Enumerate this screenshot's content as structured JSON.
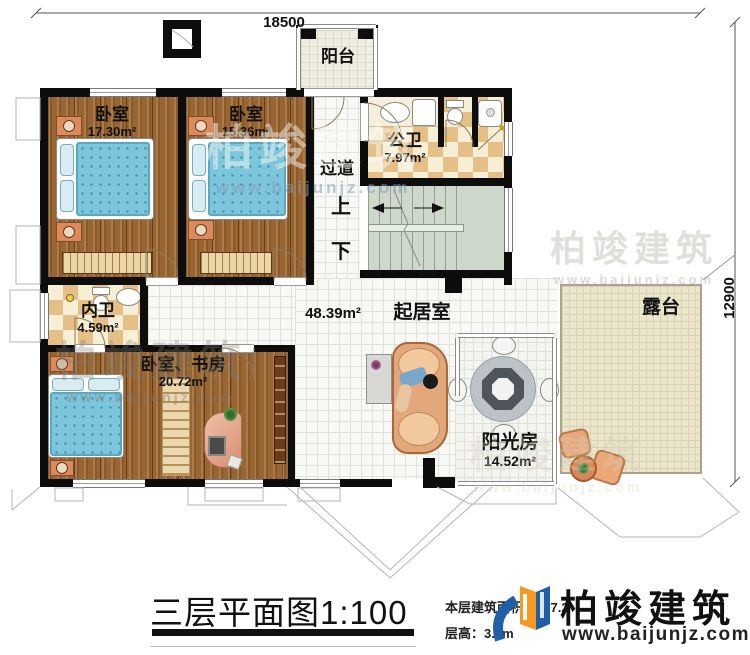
{
  "dimensions": {
    "top": "18500",
    "right": "12900"
  },
  "rooms": {
    "balcony": {
      "name": "阳台"
    },
    "bedroom1": {
      "name": "卧室",
      "area": "17.30m²"
    },
    "bedroom2": {
      "name": "卧室",
      "area": "15.36m²"
    },
    "public_bath": {
      "name": "公卫",
      "area": "7.97m²"
    },
    "corridor": {
      "name": "过道"
    },
    "stairs": {
      "up": "上",
      "down": "下"
    },
    "private_bath": {
      "name": "内卫",
      "area": "4.59m²"
    },
    "bedroom_study": {
      "name": "卧室、书房",
      "area": "20.72m²"
    },
    "living": {
      "name": "起居室",
      "area": "48.39m²"
    },
    "sunroom": {
      "name": "阳光房",
      "area": "14.52m²"
    },
    "terrace": {
      "name": "露台"
    }
  },
  "title": {
    "text": "三层平面图1:100"
  },
  "info": {
    "area_label": "本层建筑面积：",
    "area_value": "137.2",
    "height_label": "层高：",
    "height_value": "3.3m"
  },
  "logo": {
    "name": "柏竣建筑",
    "url": "www.baijunjz.com"
  },
  "watermark": {
    "name": "柏竣建筑",
    "url": "www.baijunjz.com"
  },
  "colors": {
    "wall": "#0d0d0d",
    "wood_floor": "#996633",
    "tile_accent": "#e4bf86",
    "bed": "#7cc5da",
    "logo_blue": "#1f5fa8",
    "logo_orange": "#f59a1e"
  }
}
